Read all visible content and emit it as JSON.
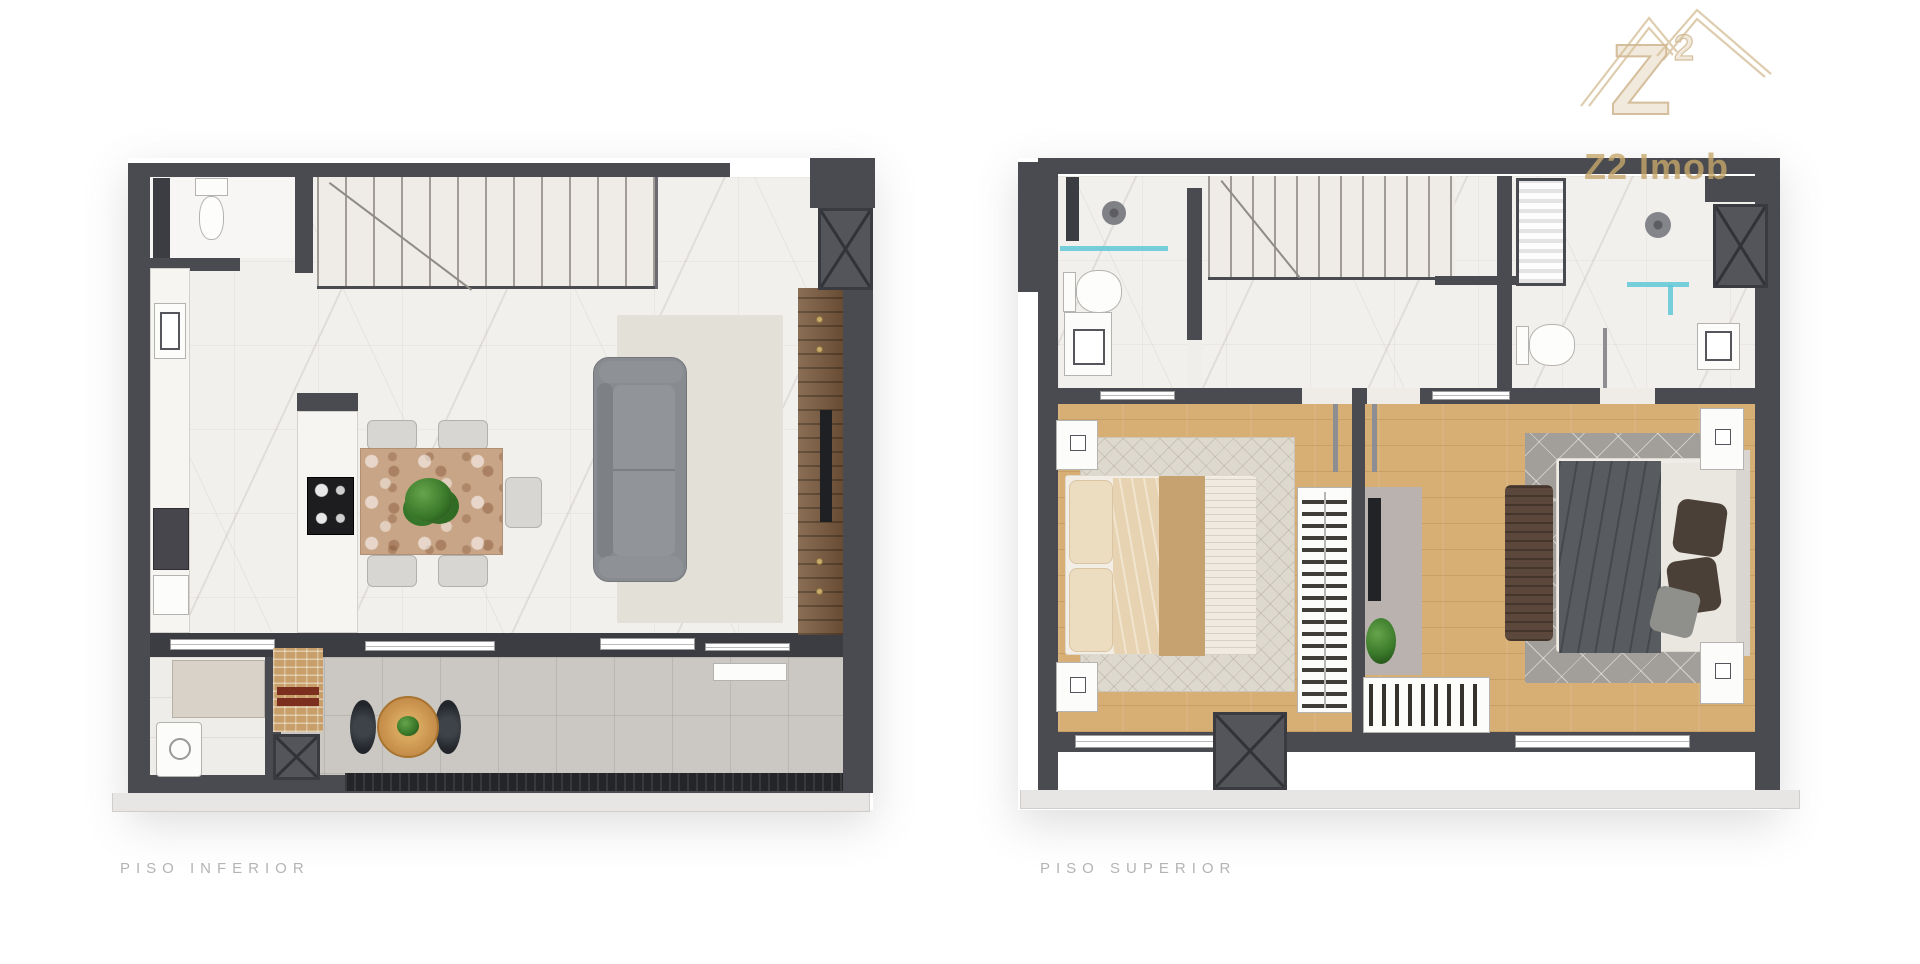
{
  "page": {
    "width": 1920,
    "height": 964,
    "background": "#ffffff"
  },
  "branding": {
    "monogram": "Z",
    "monogram_exponent": "2",
    "wordmark": "Z2 Imob",
    "color": "#c7a669"
  },
  "plans": {
    "lower": {
      "label": "PISO INFERIOR"
    },
    "upper": {
      "label": "PISO SUPERIOR"
    }
  },
  "palette": {
    "wall": "#4a4b51",
    "marble_floor": "#f2f0ed",
    "wood_floor": "#d7ae74",
    "balcony_floor": "#cbc7c2",
    "slab_edge": "#e7e6e4",
    "label_text": "#b4b4b4",
    "glass_partition": "#5fc8d5",
    "sofa": "#888b8f",
    "tv_panel_wood": "#7a5a3d",
    "grill_brick": "#c89f69",
    "plant": "#3e7d2e",
    "rug_light": "#ded9ce",
    "rug_dark": "#a29e9a",
    "bed_runner": "#c7a271",
    "duvet": "#585c61"
  }
}
